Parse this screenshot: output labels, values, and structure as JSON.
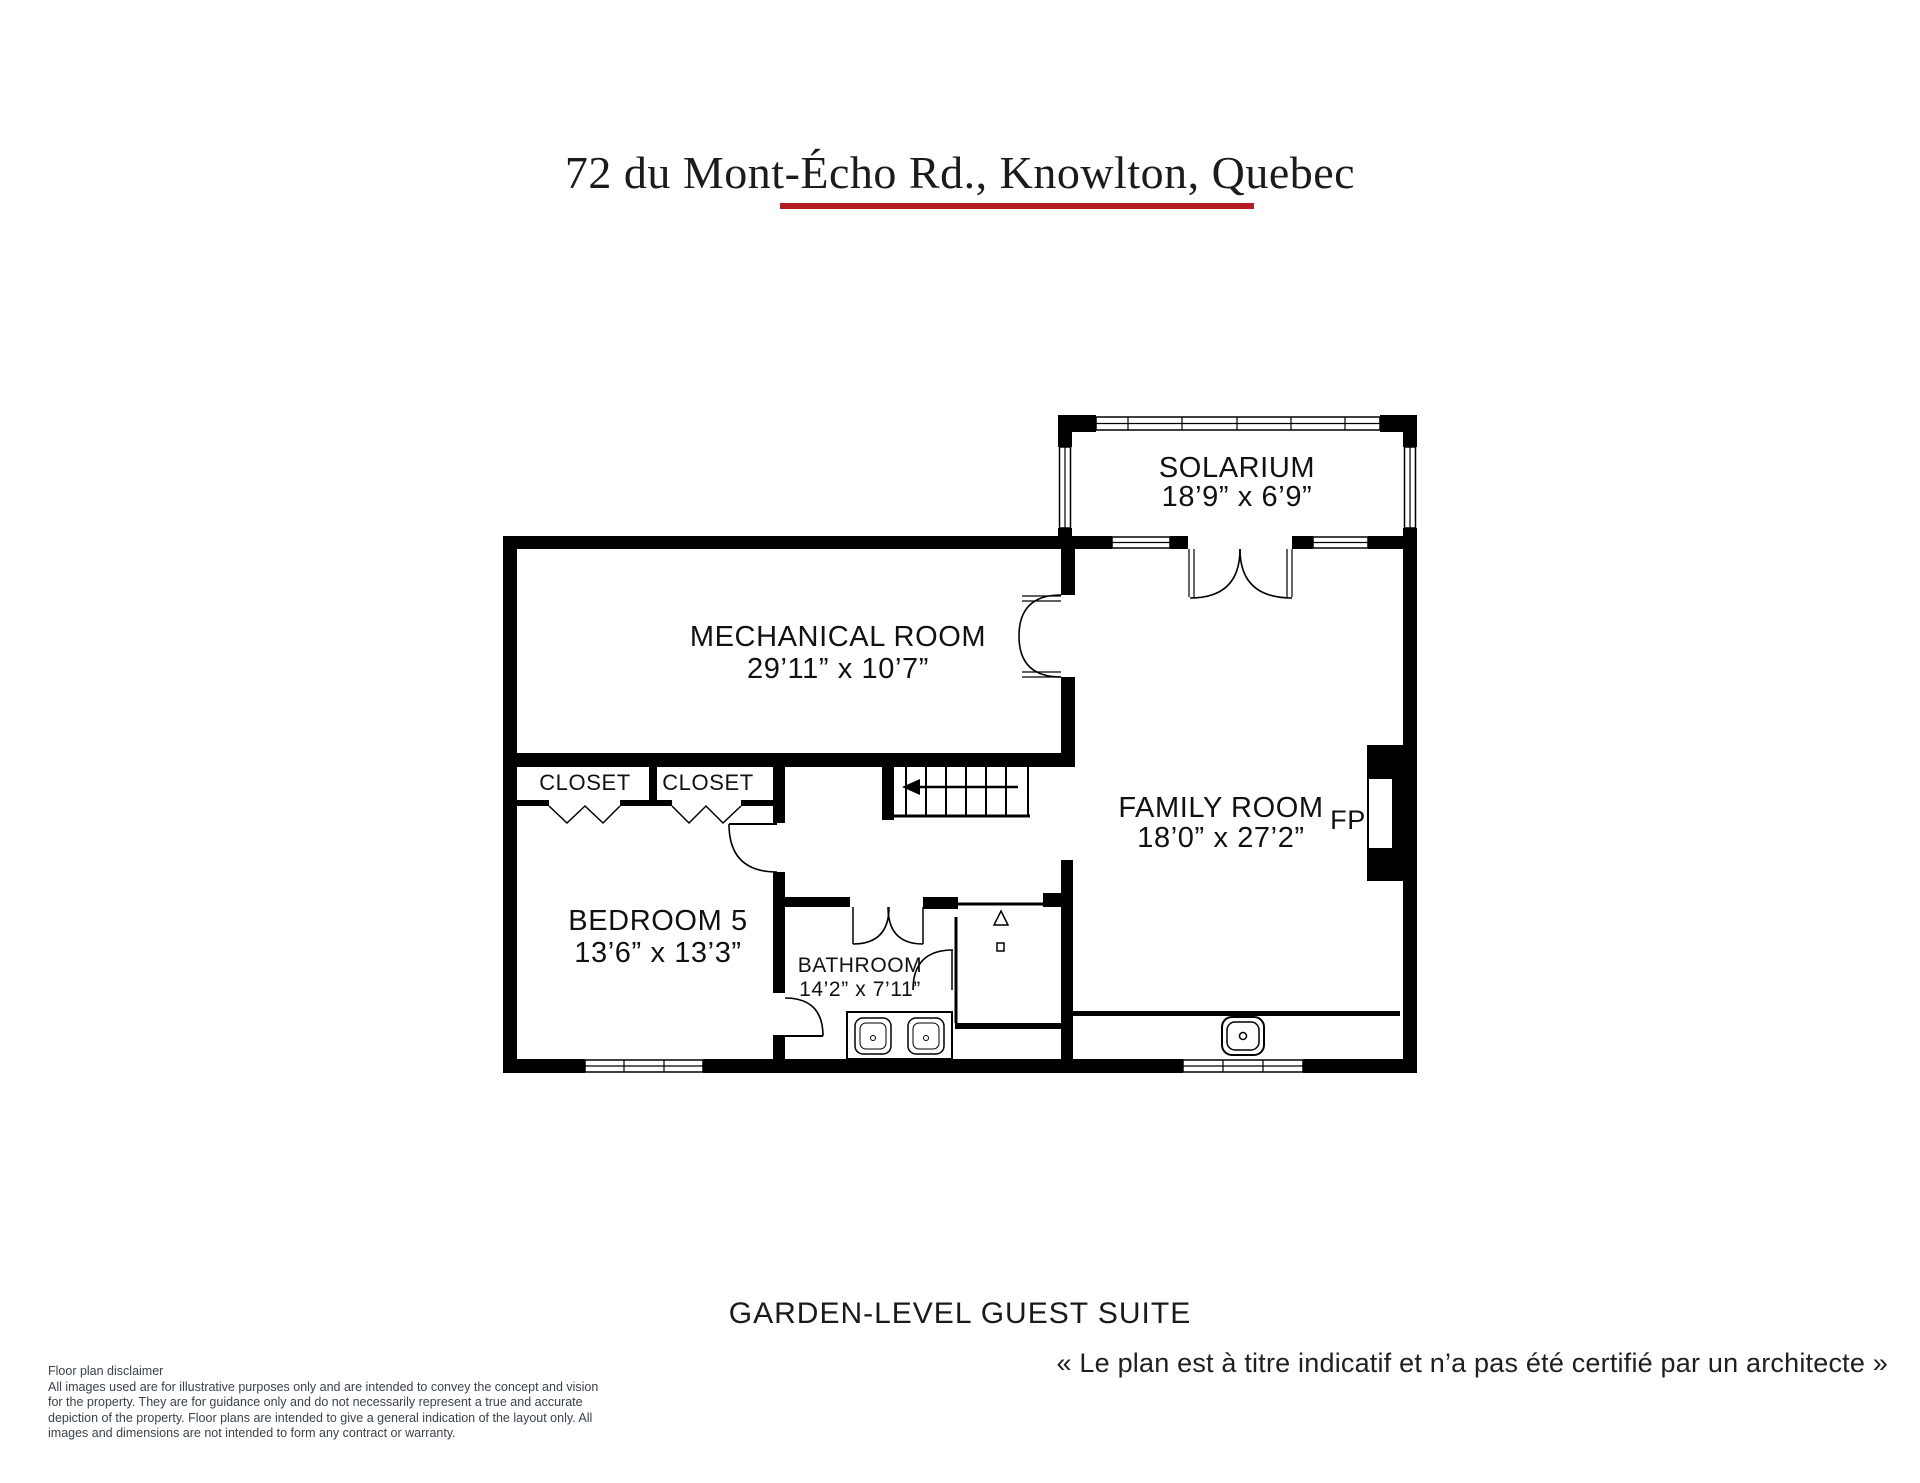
{
  "header": {
    "title": "72 du Mont-Écho Rd., Knowlton, Quebec",
    "accent_color": "#b51d22"
  },
  "footer": {
    "floor_label": "GARDEN-LEVEL GUEST SUITE",
    "caption_fr": "« Le plan est à titre indicatif et n’a pas été certifié par un architecte »"
  },
  "rooms": {
    "solarium": {
      "name": "SOLARIUM",
      "dims": "18’9” x 6’9”"
    },
    "mechanical": {
      "name": "MECHANICAL ROOM",
      "dims": "29’11” x 10’7”"
    },
    "closet1": {
      "name": "CLOSET"
    },
    "closet2": {
      "name": "CLOSET"
    },
    "family": {
      "name": "FAMILY ROOM",
      "dims": "18’0” x 27’2”"
    },
    "fireplace": {
      "abbr": "FP"
    },
    "bedroom5": {
      "name": "BEDROOM 5",
      "dims": "13’6” x 13’3”"
    },
    "bathroom": {
      "name": "BATHROOM",
      "dims": "14’2” x 7’11”"
    }
  },
  "disclaimer": {
    "heading": "Floor plan disclaimer",
    "lines": [
      "All images used are for illustrative purposes only and are intended to convey the concept and vision",
      "for the property. They are for guidance only and do not necessarily represent a true and accurate",
      "depiction of the property. Floor plans are intended to give a general indication of the layout only. All",
      "images and dimensions are not intended to form any contract or warranty."
    ]
  }
}
